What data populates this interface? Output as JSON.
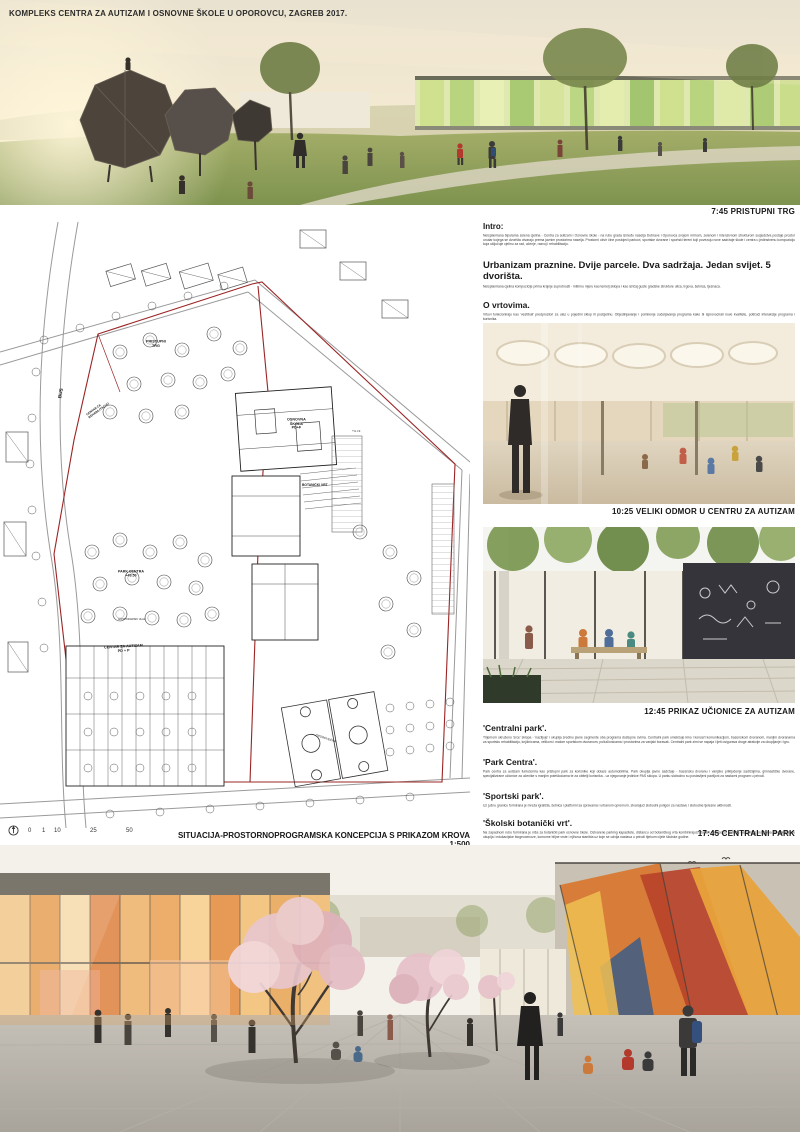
{
  "board": {
    "title": "KOMPLEKS CENTRA ZA AUTIZAM I OSNOVNE ŠKOLE U OPOROVCU, ZAGREB 2017."
  },
  "hero_top": {
    "caption": "7:45 PRISTUPNI TRG"
  },
  "plan": {
    "caption": "SITUACIJA-PROSTORNOPROGRAMSKA KONCEPCIJA S PRIKAZOM KROVA 1:500",
    "scale": [
      "0",
      "1",
      "10",
      "25",
      "50"
    ],
    "labels": [
      {
        "text": "PRISTUPNI\nTRG"
      },
      {
        "text": "BUS"
      },
      {
        "text": "CENTAR ZA\nREHABILITACIJU"
      },
      {
        "text": "OSNOVNA\nŠKOLA\nPD+F"
      },
      {
        "text": "+4.75"
      },
      {
        "text": "BOTANIČKI VRT"
      },
      {
        "text": "PARK CENTRA\n+49.50"
      },
      {
        "text": "CENTAR ZA AUTIZAM\nPD + P"
      },
      {
        "text": "OPOROVEČKA"
      },
      {
        "text": "GOSPODARSKI ULAZ"
      }
    ]
  },
  "column": {
    "intro_heading": "Intro:",
    "intro_text": "Neisplanirana bipolarna zelena cjelina - Centra za autizam i Osnovne škole - na rubu grada između naselja Dubrave i Oporovca svojom mirnom, zelenom i intenzivnom strukturom susjedstva postaje prostor unutar kojega se dvorišta otvaraju prema javnim prostorima naselja. Prostorni okvir čine postojeći parkovi, sportske dvorane i sportski tereni koji povezuju nove sadržaje škole i centra u jedinstvenu kompoziciju koja uključuje cjelinu za rad, učenje, razvoj i rehabilitaciju.",
    "h1": "Urbanizam praznine. Dvije parcele. Dva sadržaja. Jedan svijet. 5 dvorišta.",
    "p1": "Neisplanirana cjelina kompozicije prima krajnje suprotnosti - intimnu mjeru kao temelj sklopa i kao izričaj guste gradske strukture ulica, trgova, šetnica, tjesnaca.",
    "h2": "O vrtovima.",
    "p2": "Vrtovi funkcioniraju kao 'vestibuli' predprostori za ulaz u pojedini sklop ili podcjelinu. Objedinjavanje i pomirenje sučeljavanja programa kako bi isprovocirali nove kvalitete, potičući interakcije programa i korisnika.",
    "h3": "Predvrt. Pristupni trg/vrt.",
    "p3": "Kao niša na glavnoj gradskoj prometnici pristupni trg otvara se prema svojoj okolini i oblikuje zvučni prag parka te prijelaz prema predvrtu. Pristupni trg otvara ulicu sklopa, trg okuplja i distribuira korisnike pod pristupni trijem pod kojim se diferencirajući pokazuju prostori i smjerovi kretanja prema kontaktima centra za autizam i rehabilitacijski centar.",
    "caption1": "10:25 VELIKI ODMOR U CENTRU ZA AUTIZAM",
    "caption2": "12:45 PRIKAZ UČIONICE ZA AUTIZAM",
    "h4": "'Centralni park'.",
    "p4": "Trijemom okruženo 'srce' sklopa - 'naziljuje' i okuplja sredinu javne segmente oba programa dostupne svima. Centralni park omekšuje kino i koncert komunikacijom, bazenskom dvoranom, manjim dvoranama za sportsku rehabilitaciju, knjižnicama, velikom i malom sportskom dvoranom, poliučionicama i prostorima za vanjski boravak. Centralni park zimi se napaja i ljeti osigurava druge atrakcije za okupljanje i igru.",
    "h5": "'Park Centra'.",
    "p5": "Park centra za autizam funkcionira kao pristupni park za korisnike koji dolaze automobilima. Park okuplja javne sadržaje - bazensku dvoranu i vanjsko priključenje sadržajima, gimnastičke dvorane, specijalizirane učionice za učenike s manjim poteškoćama te za obitelji korisnika - uz njegovanje jedinice PAS sklopa. U parku slobodno su postavljeni paviljoni za nastavni program u prirodi.",
    "h6": "'Sportski park'.",
    "p6": "Uz južnu granicu formirana je mreža igrališta, šetnica i platformi sa spravama i urbanom opremom, stvarajući slobodni poligon za nastavu i slobodne tjelesne aktivnosti.",
    "h7": "'Školski botanički vrt'.",
    "p7": "Na zapadnom rubu formirana je niša za botanički park osnovne škole. Ostvarene parking kapacitete, distancu od botaničkog vrta kombinirajući stabla i trajnice za potrebe nastavnog programa. Botanički park okuplja i edukacijske biogeocenoze, komorne biljne vrste i njihova staništa uz koje se odvija nastava u prirodi tijekom cijele školske godine.",
    "caption3": "17:45 CENTRALNI PARK"
  },
  "colors": {
    "boundary_red": "#9b2424",
    "caption_black": "#161616",
    "facade_orange": "#e8a35c",
    "blossom_pink": "#e9c6cd",
    "glass_green": "#cfe08e"
  }
}
